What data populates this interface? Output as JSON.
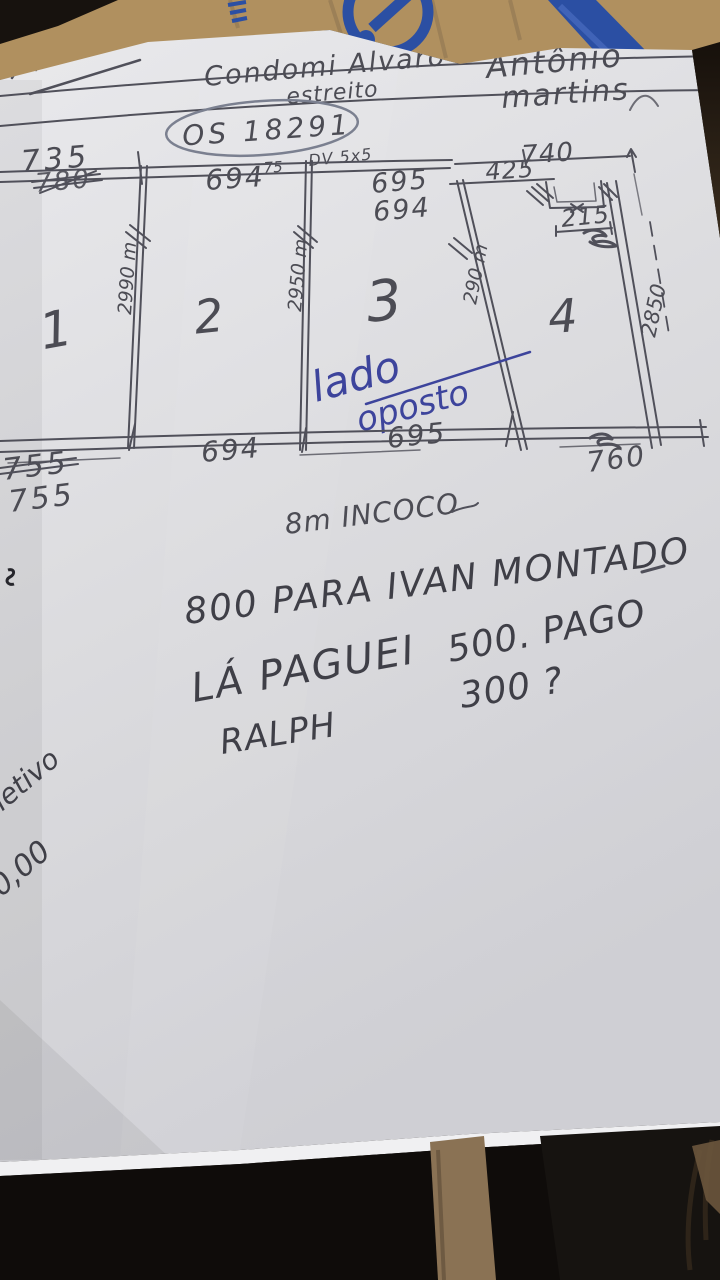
{
  "meta": {
    "kind": "photo of handwritten work-order sketch",
    "paper_color": "#dcdcdf",
    "pencil_color": "#4c4c54",
    "pen_color": "#3d449c",
    "tape_color": "#2b4fa3",
    "cardboard_color": "#b0905f"
  },
  "header": {
    "company_line": "Condomi Alvaro",
    "company_line2": "estreito",
    "customer_first": "Antônio",
    "customer_last": "martins",
    "os_number": "OS 18291"
  },
  "diagram": {
    "top_dims": {
      "left": "735",
      "left_struck": "780",
      "panel2": "694",
      "panel2_sup": "75",
      "note": "DV 5x5",
      "panel3": "695",
      "panel3_alt": "694",
      "recess_left": "425",
      "recess_total": "740",
      "recess_inner": "215"
    },
    "heights": {
      "divider1": "2990 m",
      "divider2": "2950 m",
      "divider3": "290 m",
      "right": "2850"
    },
    "panels": [
      "1",
      "2",
      "3",
      "4"
    ],
    "blue_note": {
      "word1": "lado",
      "word2": "oposto"
    },
    "bottom_dims": {
      "left_struck": "755",
      "left": "755",
      "panel2": "694",
      "panel3": "695",
      "right": "760"
    }
  },
  "notes": {
    "material": "8m INCOCO",
    "payment1": "800 PARA IVAN MONTADO",
    "payment2a": "LÁ PAGUEI",
    "payment2b": "500. PAGO",
    "payment3": "300 ?",
    "signature": "RALPH",
    "side1": "Refletivo",
    "side2": "400,00"
  }
}
